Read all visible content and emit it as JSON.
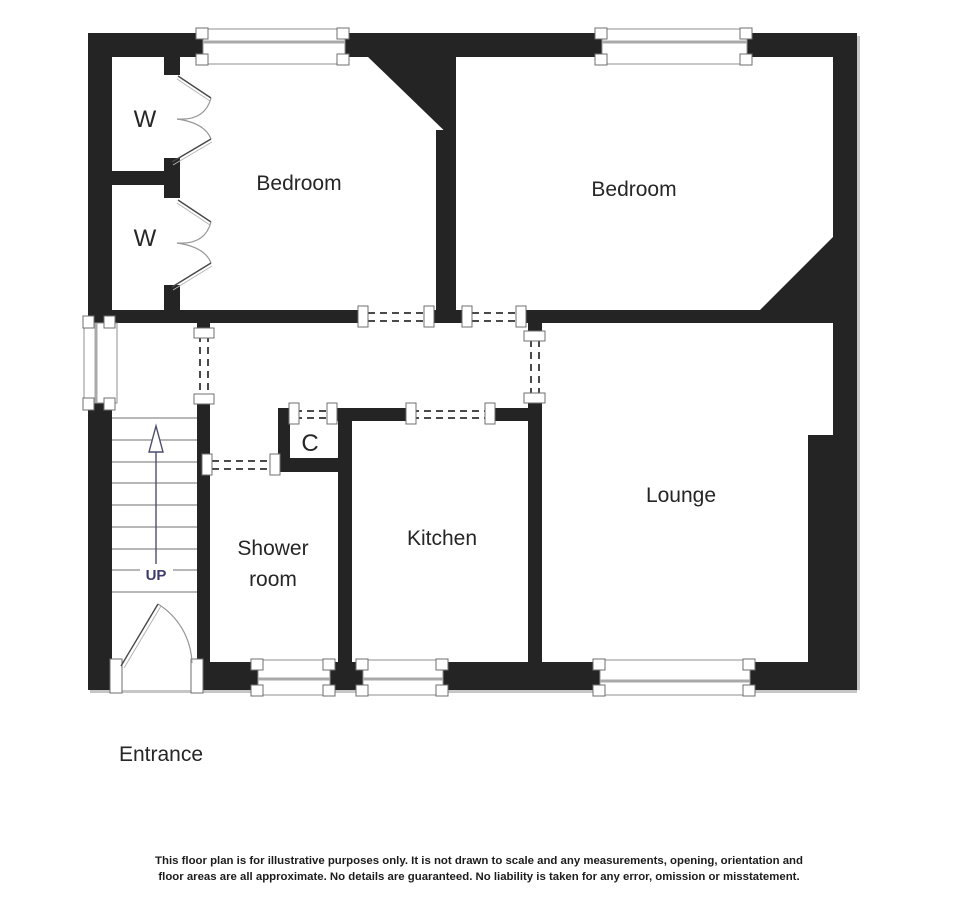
{
  "floorplan": {
    "labels": {
      "bedroom_left": "Bedroom",
      "bedroom_right": "Bedroom",
      "lounge": "Lounge",
      "kitchen": "Kitchen",
      "shower_room_line1": "Shower",
      "shower_room_line2": "room",
      "wardrobe_top": "W",
      "wardrobe_bottom": "W",
      "cupboard": "C",
      "stairs_up": "UP",
      "entrance": "Entrance"
    },
    "disclaimer": {
      "line1": "This floor plan is for illustrative purposes only. It is not drawn to scale and any measurements, opening, orientation and",
      "line2": "floor areas are all approximate. No details are guaranteed. No liability is taken for any error, omission or misstatement."
    },
    "colors": {
      "wall": "#242424",
      "label_text": "#262626",
      "up_text": "#3c3c6e",
      "window_line": "#a9a9a9",
      "window_border": "#8f8f8f",
      "dashed_opening": "#4a4a4a",
      "stair_tread": "#8c8c8c"
    }
  }
}
